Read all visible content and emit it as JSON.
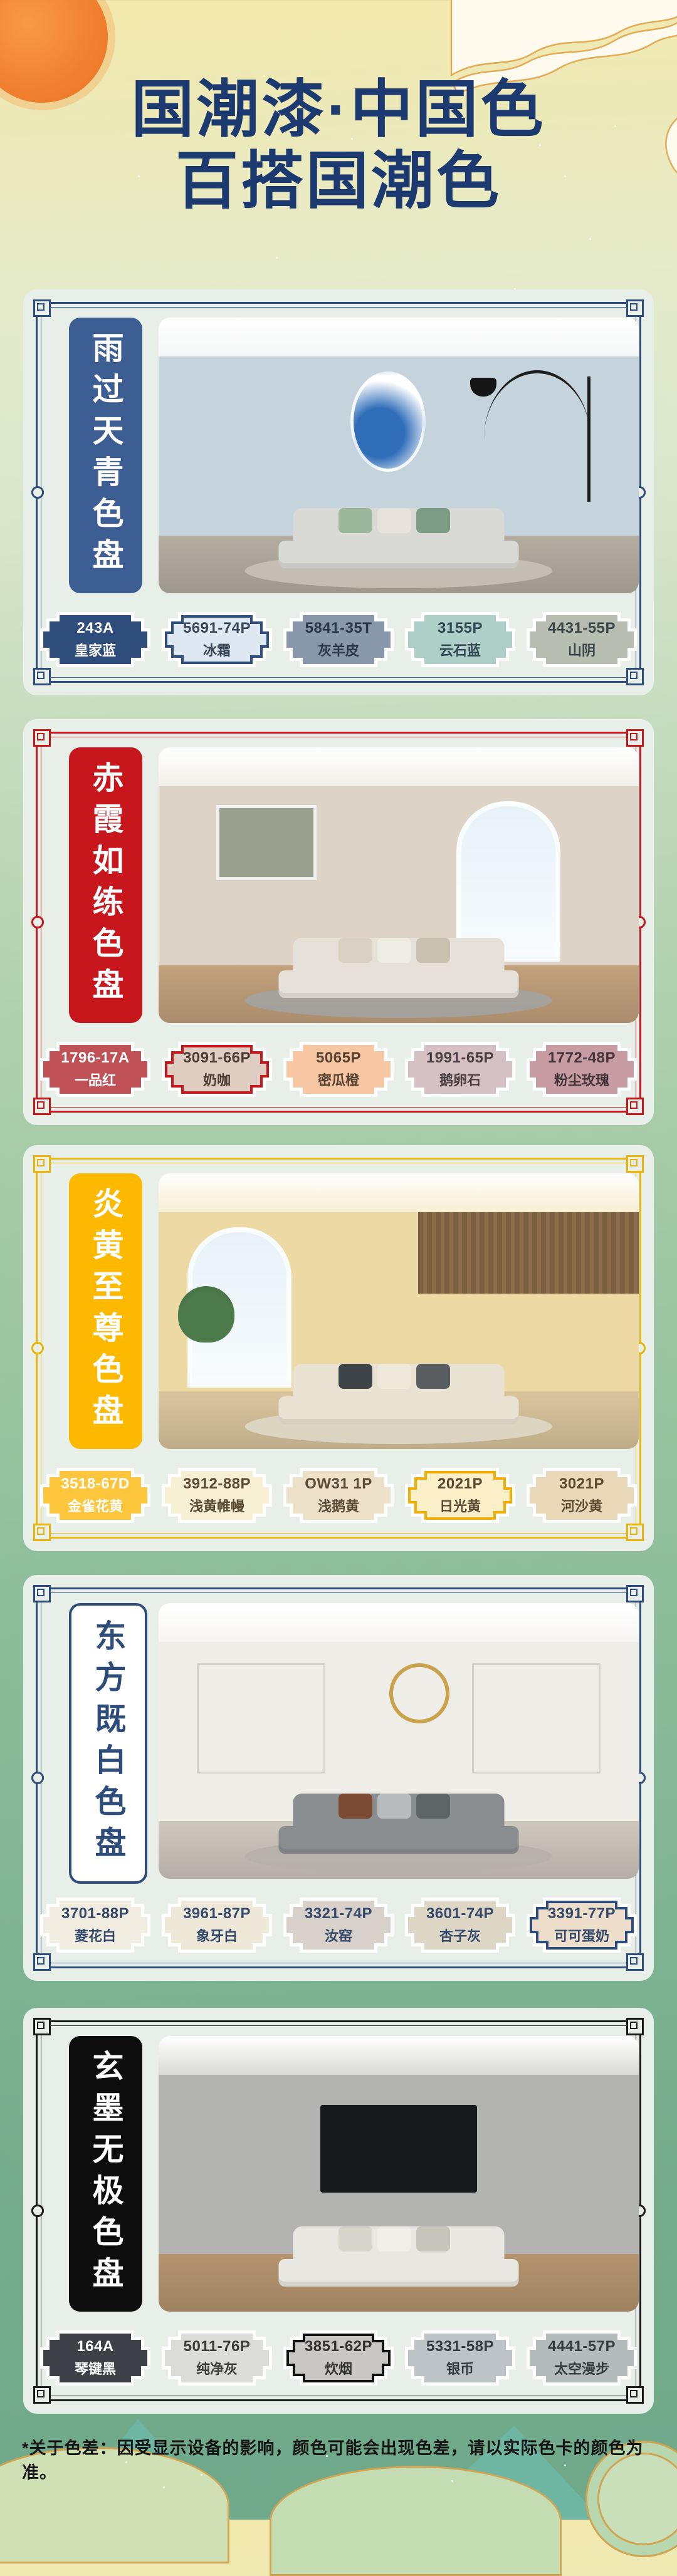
{
  "page": {
    "title_line1": "国潮漆·中国色",
    "title_line2": "百搭国潮色",
    "title_color": "#1d3a70",
    "footer_note": "*关于色差：因受显示设备的影响，颜色可能会出现色差，请以实际色卡的颜色为准。"
  },
  "palettes": [
    {
      "name": "雨过天青色盘",
      "theme": "#2e4d7b",
      "label": {
        "bg": "#3c5e93",
        "text": "#ffffff",
        "border": ""
      },
      "photo": {
        "ceiling": "#f5f6f6",
        "wall": "#c5d3dc",
        "floor": "#b3ada2",
        "rug": "#c6c1b6",
        "sofa": "#d9d9d6",
        "cushions": [
          "#9cb79b",
          "#e7e3da",
          "#7d9c85"
        ],
        "art": "oval",
        "art_color": "#2f6db8",
        "lamp": true
      },
      "swatches": [
        {
          "code": "243A",
          "name": "皇家蓝",
          "fill": "#2e4d7b",
          "text": "#ffffff",
          "outline": ""
        },
        {
          "code": "5691-74P",
          "name": "冰霜",
          "fill": "#dde8f2",
          "text": "#3a4758",
          "outline": "#2e4d7b"
        },
        {
          "code": "5841-35T",
          "name": "灰羊皮",
          "fill": "#8897aa",
          "text": "#2c3646",
          "outline": ""
        },
        {
          "code": "3155P",
          "name": "云石蓝",
          "fill": "#aecfc8",
          "text": "#334653",
          "outline": ""
        },
        {
          "code": "4431-55P",
          "name": "山阴",
          "fill": "#b7bdb0",
          "text": "#394549",
          "outline": ""
        }
      ]
    },
    {
      "name": "赤霞如练色盘",
      "theme": "#c8161d",
      "label": {
        "bg": "#c8161d",
        "text": "#ffffff",
        "border": ""
      },
      "photo": {
        "ceiling": "#f2f0ea",
        "wall": "#ddd3c6",
        "floor": "#c2a17c",
        "rug": "#a3a2a0",
        "sofa": "#e6e1d8",
        "cushions": [
          "#d8d2c4",
          "#efece4",
          "#c9c2b2"
        ],
        "art": "rect",
        "art_color": "#9aa08f",
        "window": true,
        "lamp": false
      },
      "swatches": [
        {
          "code": "1796-17A",
          "name": "一品红",
          "fill": "#c05157",
          "text": "#ffffff",
          "outline": ""
        },
        {
          "code": "3091-66P",
          "name": "奶咖",
          "fill": "#decdc0",
          "text": "#4c3b33",
          "outline": "#c8161d"
        },
        {
          "code": "5065P",
          "name": "密瓜橙",
          "fill": "#f7c7a4",
          "text": "#55412f",
          "outline": ""
        },
        {
          "code": "1991-65P",
          "name": "鹅卵石",
          "fill": "#d5c0c3",
          "text": "#4a3f44",
          "outline": ""
        },
        {
          "code": "1772-48P",
          "name": "粉尘玫瑰",
          "fill": "#c79da3",
          "text": "#44333a",
          "outline": ""
        }
      ]
    },
    {
      "name": "炎黄至尊色盘",
      "theme": "#e9b40b",
      "label": {
        "bg": "#fcb900",
        "text": "#ffffff",
        "border": ""
      },
      "photo": {
        "ceiling": "#f7eed3",
        "wall": "#ecd9a4",
        "floor": "#d9c59d",
        "rug": "#ded8c8",
        "sofa": "#e9e2d2",
        "cushions": [
          "#3e4448",
          "#efe9dc",
          "#5a5e60"
        ],
        "art": "none",
        "window": true,
        "slats": true,
        "plant": true
      },
      "swatches": [
        {
          "code": "3518-67D",
          "name": "金雀花黄",
          "fill": "#fdc63d",
          "text": "#ffffff",
          "outline": ""
        },
        {
          "code": "3912-88P",
          "name": "浅黄帷幔",
          "fill": "#f7efd4",
          "text": "#5a4a32",
          "outline": ""
        },
        {
          "code": "OW31 1P",
          "name": "浅鹅黄",
          "fill": "#ece0c9",
          "text": "#5a4a32",
          "outline": ""
        },
        {
          "code": "2021P",
          "name": "日光黄",
          "fill": "#faefc6",
          "text": "#5a4a32",
          "outline": "#f3ac00"
        },
        {
          "code": "3021P",
          "name": "河沙黄",
          "fill": "#e9d9b8",
          "text": "#5a4a32",
          "outline": ""
        }
      ]
    },
    {
      "name": "东方既白色盘",
      "theme": "#2e4d7b",
      "label": {
        "bg": "#ffffff",
        "text": "#2e4d7b",
        "border": "#2e4d7b"
      },
      "photo": {
        "ceiling": "#f6f5f2",
        "wall": "#efede7",
        "floor": "#cdc7bd",
        "rug": "#b5b0a8",
        "sofa": "#8b8e91",
        "cushions": [
          "#7a4a33",
          "#b9bcbe",
          "#5f6467"
        ],
        "art": "sun",
        "art_color": "#c9a24c",
        "moldings": true
      },
      "swatches": [
        {
          "code": "3701-88P",
          "name": "菱花白",
          "fill": "#f0ece0",
          "text": "#35496b",
          "outline": ""
        },
        {
          "code": "3961-87P",
          "name": "象牙白",
          "fill": "#ede8d8",
          "text": "#35496b",
          "outline": ""
        },
        {
          "code": "3321-74P",
          "name": "汝窑",
          "fill": "#d8d1ca",
          "text": "#35496b",
          "outline": ""
        },
        {
          "code": "3601-74P",
          "name": "杏子灰",
          "fill": "#ded7c5",
          "text": "#35496b",
          "outline": ""
        },
        {
          "code": "3391-77P",
          "name": "可可蛋奶",
          "fill": "#ecdecb",
          "text": "#35496b",
          "outline": "#2e4d7b"
        }
      ]
    },
    {
      "name": "玄墨无极色盘",
      "theme": "#1a1a1a",
      "label": {
        "bg": "#0d0d0d",
        "text": "#ffffff",
        "border": ""
      },
      "photo": {
        "ceiling": "#d9d9d7",
        "wall": "#b2b2b0",
        "floor": "#b5946f",
        "rug": "",
        "sofa": "#e9e7e1",
        "cushions": [
          "#d8d5cd",
          "#f0eee8",
          "#c7c4bc"
        ],
        "art": "none",
        "tv": true
      },
      "swatches": [
        {
          "code": "164A",
          "name": "琴键黑",
          "fill": "#3d4147",
          "text": "#ffffff",
          "outline": ""
        },
        {
          "code": "5011-76P",
          "name": "纯净灰",
          "fill": "#dcdcda",
          "text": "#3c3c3c",
          "outline": ""
        },
        {
          "code": "3851-62P",
          "name": "炊烟",
          "fill": "#c9c8c4",
          "text": "#333333",
          "outline": "#111111"
        },
        {
          "code": "5331-58P",
          "name": "银币",
          "fill": "#bcc4c8",
          "text": "#343c40",
          "outline": ""
        },
        {
          "code": "4441-57P",
          "name": "太空漫步",
          "fill": "#b3bbbb",
          "text": "#343c3c",
          "outline": ""
        }
      ]
    }
  ]
}
